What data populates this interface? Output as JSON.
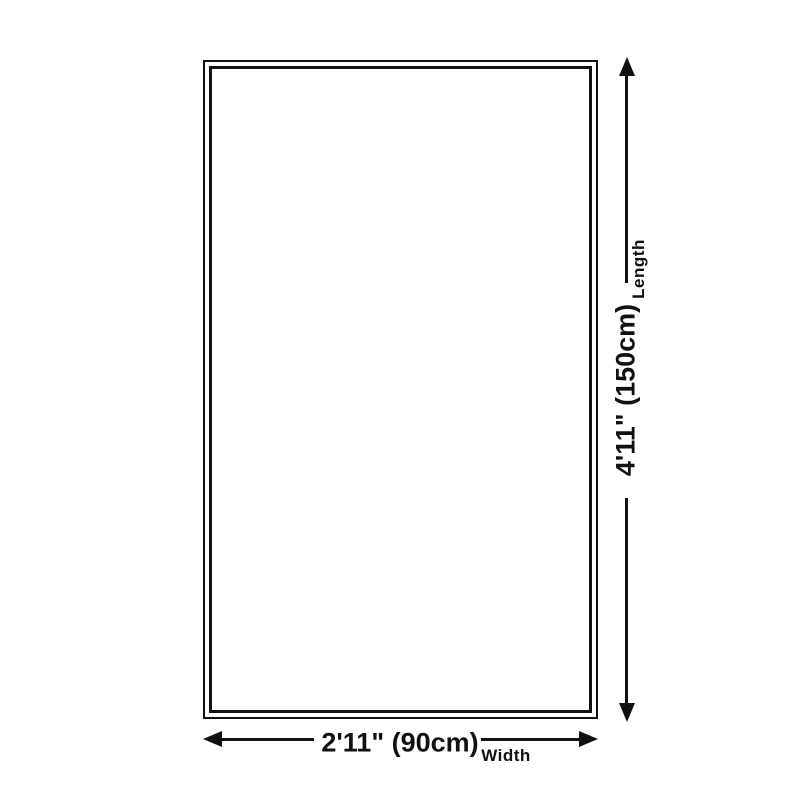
{
  "colors": {
    "line": "#111111",
    "background": "#ffffff"
  },
  "length_dimension": {
    "value": "4'11\" (150cm)",
    "label": "Length"
  },
  "width_dimension": {
    "value": "2'11\" (90cm)",
    "label": "Width"
  }
}
